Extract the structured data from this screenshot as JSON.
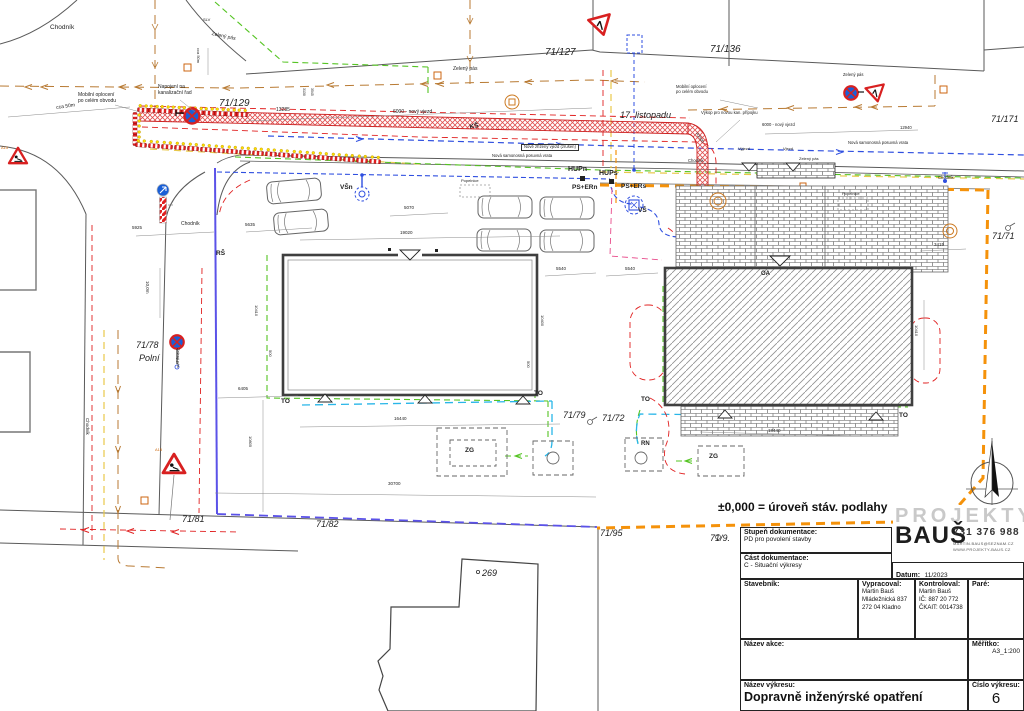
{
  "annotation": "±0,000  =  úroveň stáv. podlahy",
  "colors": {
    "trench_red": "#e02020",
    "boundary_orange": "#f5920a",
    "site_boundary_blue": "#5b52e8",
    "utility_blue": "#2f4fe0",
    "utility_green": "#55c423",
    "utility_cyan": "#29b6e8",
    "utility_yellow": "#e8c84a",
    "fence_brown": "#b87a33",
    "utility_magenta": "#e84a8a",
    "sign_blue": "#1a5fd6"
  },
  "title_block": {
    "stupen_label": "Stupeň dokumentace:",
    "stupen_value": "PD pro povolení stavby",
    "cast_label": "Část dokumentace:",
    "cast_value": "C - Situační výkresy",
    "datum_label": "Datum:",
    "datum_value": "11/2023",
    "stavebnik_label": "Stavebník:",
    "vypracoval_label": "Vypracoval:",
    "vypracoval_lines": [
      "Martin Bauš",
      "Mládežnická 837",
      "272 04 Kladno"
    ],
    "kontroloval_label": "Kontroloval:",
    "kontroloval_lines": [
      "Martin Bauš",
      "IČ: 887 20 772",
      "ČKAIT: 0014738"
    ],
    "pare_label": "Paré:",
    "nazev_akce_label": "Název akce:",
    "meritko_label": "Měřítko:",
    "meritko_value": "A3_1:200",
    "nazev_vykresu_label": "Název výkresu:",
    "nazev_vykresu_value": "Dopravně inženýrské opatření",
    "cislo_vykresu_label": "Číslo výkresu:",
    "cislo_vykresu_value": "6",
    "logo": {
      "brand_top": "PROJEKTY",
      "brand_name": "BAUŠ",
      "phone": "731 376 988",
      "email": "MARTIN.BAUS@SEZNAM.CZ",
      "web": "WWW.PROJEKTY-BAUS.CZ"
    }
  },
  "labels": [
    {
      "n": "chodnik-1",
      "t": "Chodník",
      "x": 50,
      "y": 24,
      "s": 6.5
    },
    {
      "n": "sign-code-top",
      "t": "SLV",
      "x": 203,
      "y": 18,
      "s": 4
    },
    {
      "n": "zeleny-pas-1",
      "t": "Zelený pás",
      "x": 212,
      "y": 32,
      "s": 5,
      "r": 12
    },
    {
      "n": "mobilni-oploceni-1",
      "t": "Mobilní oplocení\npo celém obvodu",
      "x": 78,
      "y": 93,
      "s": 5
    },
    {
      "n": "napojeni-kanalizace",
      "t": "Napojení na\nkanalizační řad",
      "x": 158,
      "y": 85,
      "s": 5
    },
    {
      "n": "cca-50m-1",
      "t": "cca 50m",
      "x": 56,
      "y": 106,
      "s": 5,
      "r": -8
    },
    {
      "n": "parcela-71-129",
      "t": "71/129",
      "x": 219,
      "y": 98,
      "s": 10,
      "i": 1
    },
    {
      "n": "dim-13285",
      "t": "13285",
      "x": 276,
      "y": 108,
      "s": 5
    },
    {
      "n": "dim-6000-novy-vjezd-1",
      "t": "6000 - nový vjezd",
      "x": 393,
      "y": 110,
      "s": 5
    },
    {
      "n": "ks-1",
      "t": "KŠ",
      "x": 469,
      "y": 124,
      "s": 6.5,
      "b": 1,
      "r": -12
    },
    {
      "n": "parcela-71-127",
      "t": "71/127",
      "x": 545,
      "y": 47,
      "s": 10,
      "i": 1
    },
    {
      "n": "zeleny-pas-2",
      "t": "Zelený pás",
      "x": 453,
      "y": 67,
      "s": 5
    },
    {
      "n": "ulice-17-listopadu",
      "t": "17. listopadu",
      "x": 620,
      "y": 110,
      "s": 9,
      "i": 1
    },
    {
      "n": "nove-zrizeny-vjezd",
      "t": "Nově zřízený vjezd (zrušen)",
      "x": 521,
      "y": 144,
      "s": 4.2,
      "box": 1
    },
    {
      "n": "nova-vrata-1",
      "t": "Nová samonosná posuvná vrata",
      "x": 492,
      "y": 154,
      "s": 4.2
    },
    {
      "n": "hupn",
      "t": "HUPn",
      "x": 568,
      "y": 166,
      "s": 7,
      "b": 1
    },
    {
      "n": "hups",
      "t": "HUPs",
      "x": 599,
      "y": 170,
      "s": 7,
      "b": 1
    },
    {
      "n": "ps-ern",
      "t": "PS+ERn",
      "x": 572,
      "y": 184,
      "s": 6.5,
      "b": 1
    },
    {
      "n": "ps-ers",
      "t": "PS+ERs",
      "x": 621,
      "y": 183,
      "s": 6.5,
      "b": 1
    },
    {
      "n": "vsn",
      "t": "VŠn",
      "x": 340,
      "y": 184,
      "s": 6.5,
      "b": 1
    },
    {
      "n": "vs",
      "t": "VŠ",
      "x": 638,
      "y": 207,
      "s": 6.5,
      "b": 1
    },
    {
      "n": "popelnice-1",
      "t": "Popelnice",
      "x": 461,
      "y": 179,
      "s": 4
    },
    {
      "n": "popelnice-2",
      "t": "Popelnice",
      "x": 842,
      "y": 192,
      "s": 4
    },
    {
      "n": "rs",
      "t": "RŠ",
      "x": 216,
      "y": 250,
      "s": 6.5,
      "b": 1
    },
    {
      "n": "chodnik-2",
      "t": "Chodník",
      "x": 181,
      "y": 222,
      "s": 5
    },
    {
      "n": "chodnik-3",
      "t": "Chodník",
      "x": 90,
      "y": 418,
      "s": 4.5,
      "r": 90
    },
    {
      "n": "chodnik-4",
      "t": "Chodník",
      "x": 688,
      "y": 159,
      "s": 4.2
    },
    {
      "n": "chodnik-5",
      "t": "Chodník",
      "x": 938,
      "y": 176,
      "s": 4.2
    },
    {
      "n": "parcela-71-136",
      "t": "71/136",
      "x": 710,
      "y": 44,
      "s": 10,
      "i": 1
    },
    {
      "n": "zeleny-pas-3",
      "t": "Zelený pás",
      "x": 843,
      "y": 73,
      "s": 4.2
    },
    {
      "n": "mobilni-oploceni-2",
      "t": "Mobilní oplocení\npo celém obvodu",
      "x": 676,
      "y": 85,
      "s": 4.2
    },
    {
      "n": "vykop-pripojka",
      "t": "Výkop pro novou kan. přípojku",
      "x": 701,
      "y": 111,
      "s": 4.2
    },
    {
      "n": "dim-6000-novy-vjezd-2",
      "t": "6000 - nový vjezd",
      "x": 762,
      "y": 123,
      "s": 4.2
    },
    {
      "n": "dim-12940",
      "t": "12940",
      "x": 900,
      "y": 126,
      "s": 4.2
    },
    {
      "n": "nova-vrata-2",
      "t": "Nová samonosná posuvná vrata",
      "x": 848,
      "y": 141,
      "s": 4.2
    },
    {
      "n": "parcela-71-171",
      "t": "71/171",
      "x": 991,
      "y": 114,
      "s": 9,
      "i": 1
    },
    {
      "n": "parcela-71-71",
      "t": "71/71",
      "x": 992,
      "y": 231,
      "s": 9,
      "i": 1
    },
    {
      "n": "vyjezd",
      "t": "Výjezd",
      "x": 738,
      "y": 147,
      "s": 4
    },
    {
      "n": "vjezd",
      "t": "Vjezd",
      "x": 783,
      "y": 147,
      "s": 4
    },
    {
      "n": "zeleny-pas-4",
      "t": "Zelený pás",
      "x": 799,
      "y": 157,
      "s": 4
    },
    {
      "n": "oa",
      "t": "OA",
      "x": 761,
      "y": 271,
      "s": 6,
      "b": 1
    },
    {
      "n": "parcela-71-78",
      "t": "71/78",
      "x": 136,
      "y": 340,
      "s": 9,
      "i": 1
    },
    {
      "n": "ulice-polni",
      "t": "Polní",
      "x": 139,
      "y": 353,
      "s": 9,
      "i": 1
    },
    {
      "n": "zeleny-pas-5",
      "t": "Zelený pás",
      "x": 180,
      "y": 348,
      "s": 4,
      "r": 90
    },
    {
      "n": "a15-label-1",
      "t": "A15",
      "x": 155,
      "y": 448,
      "s": 4,
      "c": "#cc6a11"
    },
    {
      "n": "a15-label-2",
      "t": "A15",
      "x": 1,
      "y": 146,
      "s": 4,
      "c": "#cc6a11"
    },
    {
      "n": "dim-5925",
      "t": "5925",
      "x": 132,
      "y": 225,
      "s": 4.5
    },
    {
      "n": "dim-5635",
      "t": "5635",
      "x": 245,
      "y": 222,
      "s": 4.5
    },
    {
      "n": "dim-10m",
      "t": "10,0m",
      "x": 150,
      "y": 281,
      "s": 4.5,
      "r": 90
    },
    {
      "n": "dim-5070",
      "t": "5070",
      "x": 404,
      "y": 205,
      "s": 4.5
    },
    {
      "n": "dim-19020",
      "t": "19020",
      "x": 400,
      "y": 230,
      "s": 4.5
    },
    {
      "n": "dim-10410-l",
      "t": "10410",
      "x": 258,
      "y": 305,
      "s": 4,
      "r": 90
    },
    {
      "n": "dim-10400",
      "t": "10400",
      "x": 544,
      "y": 315,
      "s": 4,
      "r": 90
    },
    {
      "n": "dim-500-a",
      "t": "500",
      "x": 272,
      "y": 350,
      "s": 4,
      "r": 90
    },
    {
      "n": "dim-500-b",
      "t": "500",
      "x": 530,
      "y": 361,
      "s": 4,
      "r": 90
    },
    {
      "n": "dim-5540-a",
      "t": "5540",
      "x": 556,
      "y": 266,
      "s": 4.5
    },
    {
      "n": "dim-5540-b",
      "t": "5540",
      "x": 625,
      "y": 266,
      "s": 4.5
    },
    {
      "n": "dim-3415",
      "t": "3415",
      "x": 934,
      "y": 242,
      "s": 4.5
    },
    {
      "n": "dim-10410-r",
      "t": "10410",
      "x": 918,
      "y": 325,
      "s": 4,
      "r": 90
    },
    {
      "n": "dim-18440",
      "t": "18440",
      "x": 768,
      "y": 428,
      "s": 4.5
    },
    {
      "n": "to-1",
      "t": "TO",
      "x": 281,
      "y": 398,
      "s": 6.5,
      "b": 1
    },
    {
      "n": "to-2",
      "t": "TO",
      "x": 534,
      "y": 390,
      "s": 6.5,
      "b": 1
    },
    {
      "n": "to-3",
      "t": "TO",
      "x": 641,
      "y": 396,
      "s": 6.5,
      "b": 1
    },
    {
      "n": "to-4",
      "t": "TO",
      "x": 899,
      "y": 412,
      "s": 6.5,
      "b": 1
    },
    {
      "n": "zg-1",
      "t": "ZG",
      "x": 465,
      "y": 447,
      "s": 6.5,
      "b": 1
    },
    {
      "n": "zg-2",
      "t": "ZG",
      "x": 709,
      "y": 453,
      "s": 6.5,
      "b": 1
    },
    {
      "n": "rn",
      "t": "RN",
      "x": 641,
      "y": 441,
      "s": 6,
      "b": 1
    },
    {
      "n": "parcela-71-79",
      "t": "71/79",
      "x": 563,
      "y": 410,
      "s": 9,
      "i": 1
    },
    {
      "n": "parcela-71-72",
      "t": "71/72",
      "x": 602,
      "y": 413,
      "s": 9,
      "i": 1
    },
    {
      "n": "parcela-71-81",
      "t": "71/81",
      "x": 182,
      "y": 514,
      "s": 9,
      "i": 1
    },
    {
      "n": "parcela-71-82",
      "t": "71/82",
      "x": 316,
      "y": 519,
      "s": 9,
      "i": 1
    },
    {
      "n": "parcela-71-95",
      "t": "71/95",
      "x": 600,
      "y": 528,
      "s": 9,
      "i": 1
    },
    {
      "n": "parcela-71-9",
      "t": "71/9.",
      "x": 710,
      "y": 533,
      "s": 9,
      "i": 1
    },
    {
      "n": "parcela-269",
      "t": "269",
      "x": 482,
      "y": 568,
      "s": 9,
      "i": 1
    },
    {
      "n": "dim-6405",
      "t": "6405",
      "x": 238,
      "y": 386,
      "s": 4.5
    },
    {
      "n": "dim-16440",
      "t": "16440",
      "x": 394,
      "y": 416,
      "s": 4.5
    },
    {
      "n": "dim-30700",
      "t": "30700",
      "x": 388,
      "y": 481,
      "s": 4.5
    },
    {
      "n": "dim-10805",
      "t": "10805",
      "x": 252,
      "y": 436,
      "s": 4,
      "r": 90
    },
    {
      "n": "cca-50m-2",
      "t": "cca 50m",
      "x": 200,
      "y": 48,
      "s": 4,
      "r": 90
    },
    {
      "n": "dim-3130",
      "t": "3130",
      "x": 306,
      "y": 88,
      "s": 3.5,
      "r": 90
    },
    {
      "n": "dim-3545",
      "t": "3545",
      "x": 314,
      "y": 88,
      "s": 3.5,
      "r": 90
    },
    {
      "n": "radius-r2500",
      "t": "R2500",
      "x": 698,
      "y": 132,
      "s": 4,
      "r": 55
    }
  ]
}
